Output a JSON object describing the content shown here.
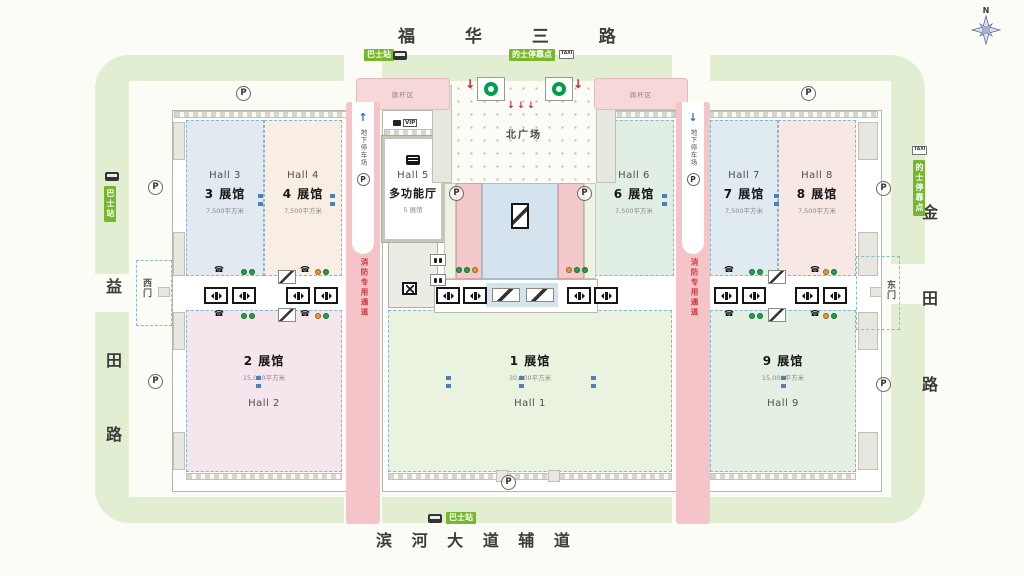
{
  "roads": {
    "north": "福 华 三 路",
    "south": "滨 河 大 道 辅 道",
    "west": "益田路",
    "east": "金田路"
  },
  "plaza": {
    "name": "北广场"
  },
  "gates": {
    "west": "西门",
    "east": "东门"
  },
  "halls": {
    "h1": {
      "en": "Hall 1",
      "num": "1 展馆",
      "area": "30,000平方米"
    },
    "h2": {
      "en": "Hall 2",
      "num": "2 展馆",
      "area": "15,000平方米"
    },
    "h3": {
      "en": "Hall 3",
      "num": "3 展馆",
      "area": "7,500平方米"
    },
    "h4": {
      "en": "Hall 4",
      "num": "4 展馆",
      "area": "7,500平方米"
    },
    "h5": {
      "en": "Hall 5",
      "name": "多功能厅",
      "num": "5 展馆"
    },
    "h6": {
      "en": "Hall 6",
      "num": "6 展馆",
      "area": "7,500平方米"
    },
    "h7": {
      "en": "Hall 7",
      "num": "7 展馆",
      "area": "7,500平方米"
    },
    "h8": {
      "en": "Hall 8",
      "num": "8 展馆",
      "area": "7,500平方米"
    },
    "h9": {
      "en": "Hall 9",
      "num": "9 展馆",
      "area": "15,000平方米"
    }
  },
  "transit": {
    "bus_stop": "巴士站",
    "taxi_stop": "的士停靠点",
    "taxi": "TAXI"
  },
  "zones": {
    "flag_area": "旗杆区",
    "fire_lane": "消防专用通道",
    "underground_parking": "地下停车场",
    "vip": "VIP"
  },
  "icons": {
    "parking": "P",
    "phone": "☎",
    "arrow_up": "↑",
    "arrow_down": "↓",
    "north": "N"
  },
  "colors": {
    "road_green": "#e2eed1",
    "label_green": "#76b82a",
    "fire_lane_pink": "#f5c4c9",
    "metro_green": "#00a04a",
    "arrow_red": "#c4272b"
  }
}
